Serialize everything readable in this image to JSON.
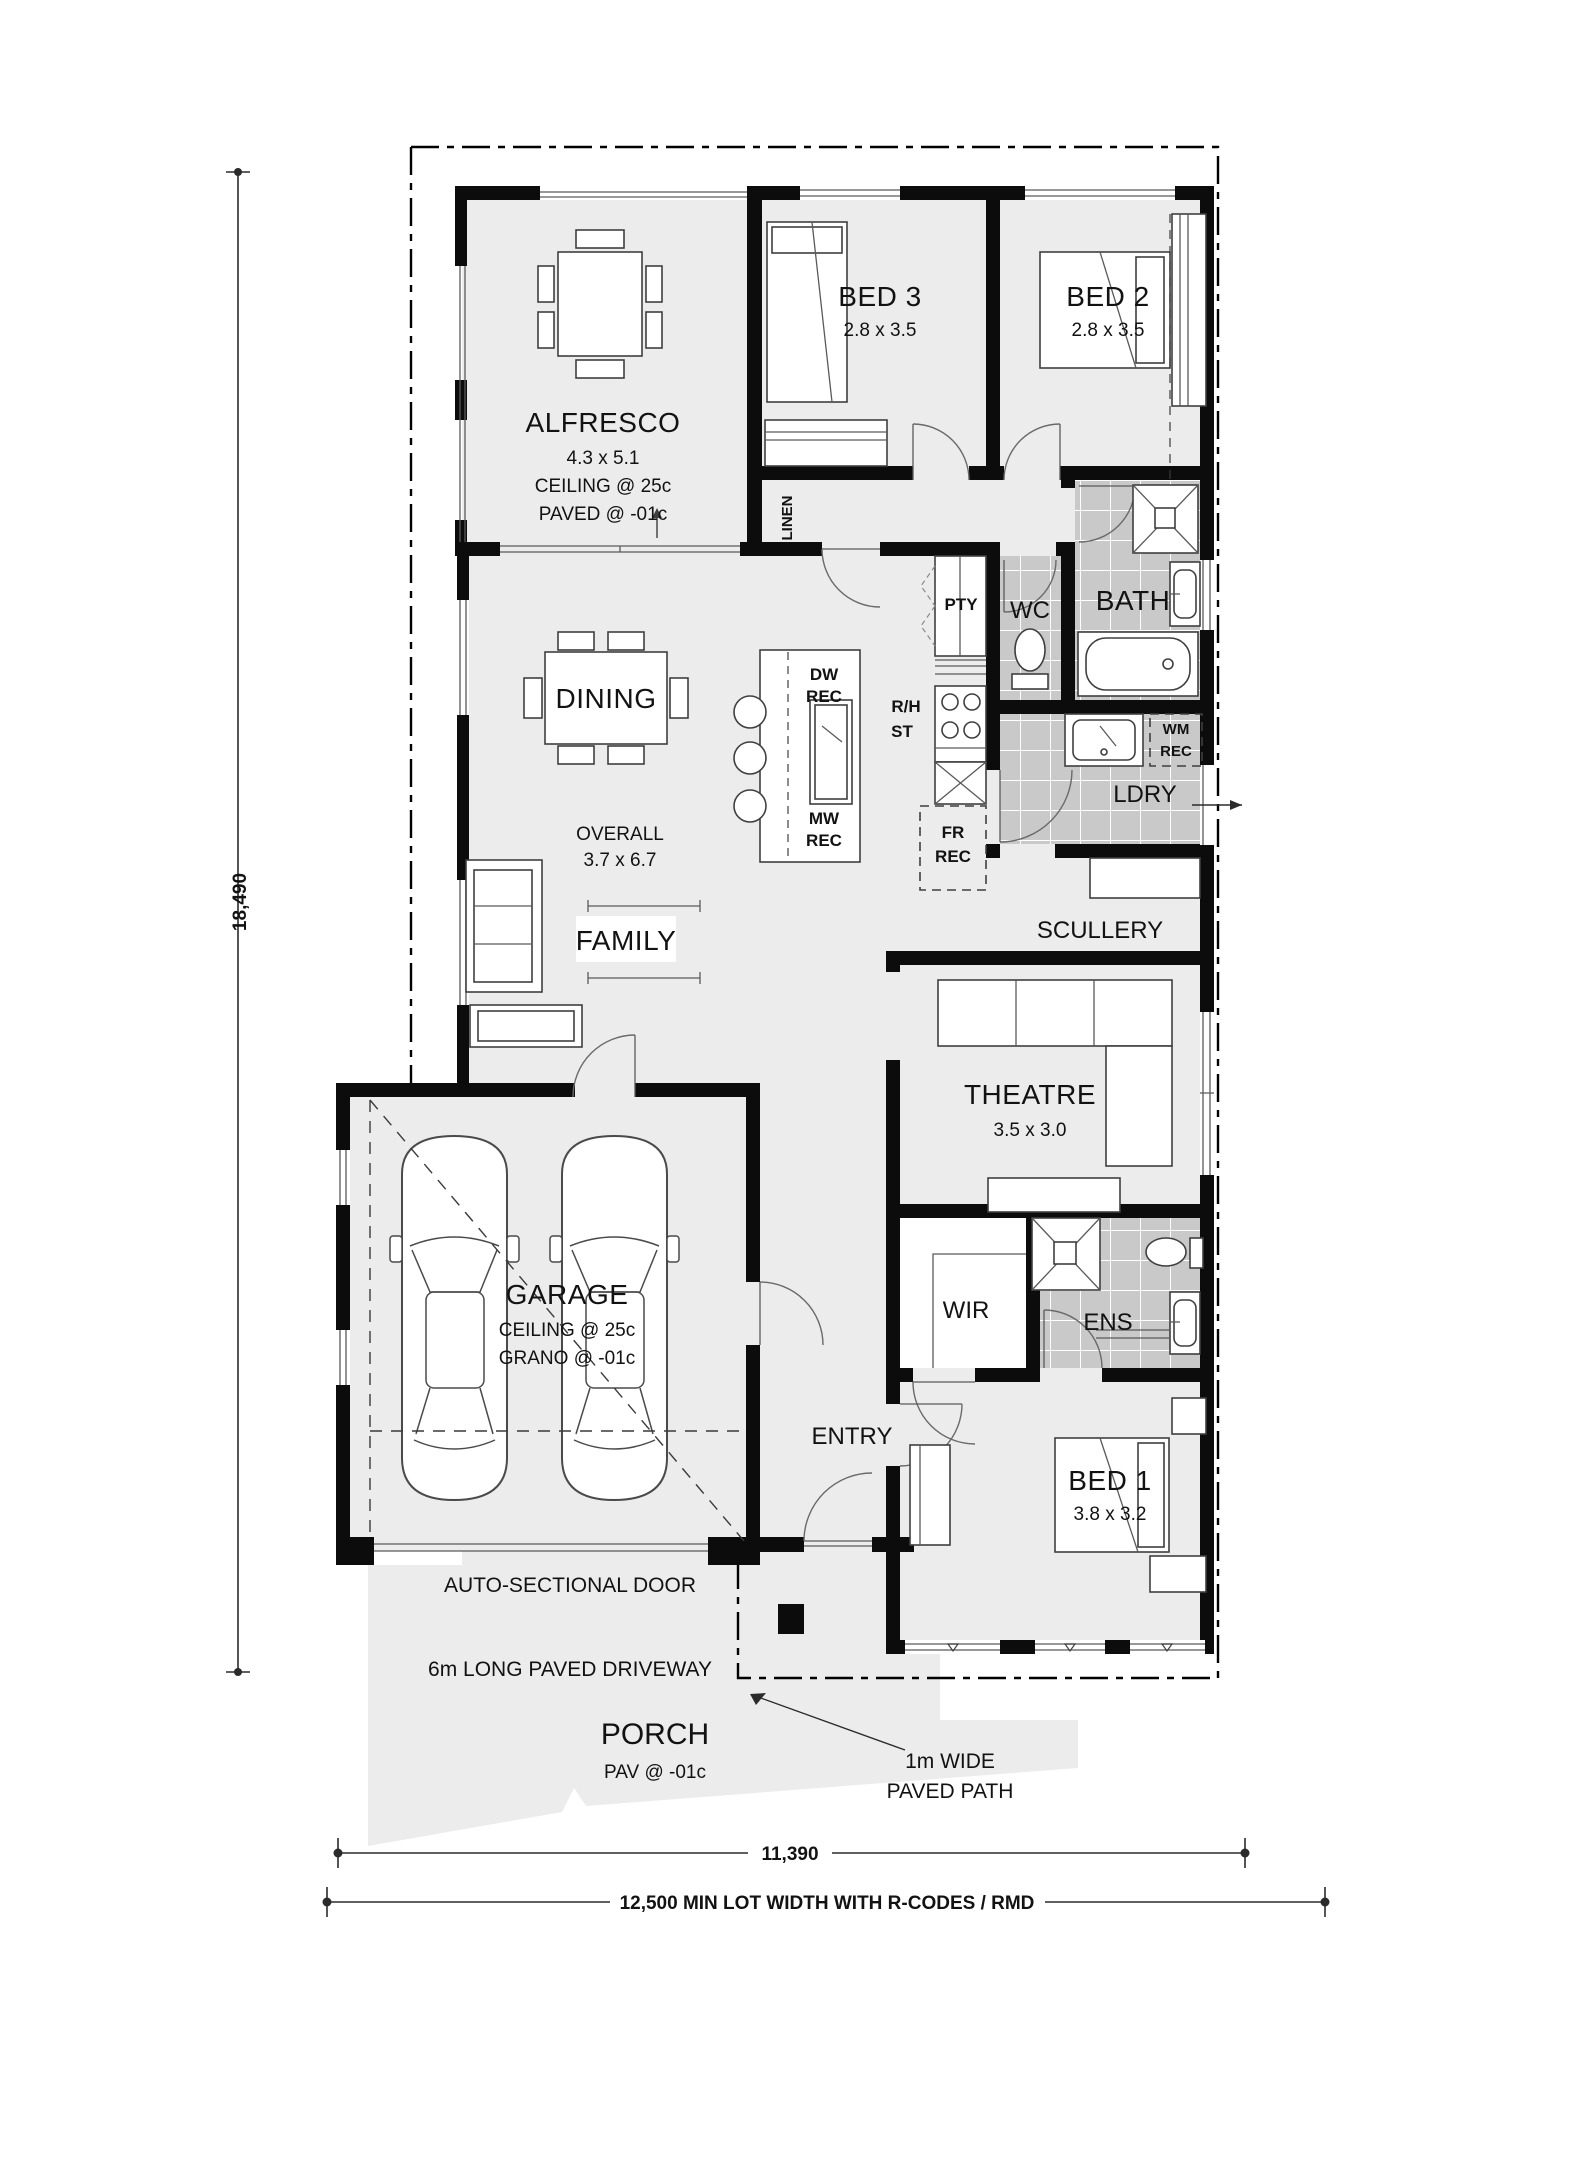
{
  "colors": {
    "wall": "#0c0c0c",
    "floor": "#ececec",
    "tile": "#c9c9c9",
    "paper": "#ffffff"
  },
  "rooms": {
    "alfresco": {
      "name": "ALFRESCO",
      "dim": "4.3 x 5.1",
      "notes": [
        "CEILING @ 25c",
        "PAVED @ -01c"
      ]
    },
    "bed3": {
      "name": "BED 3",
      "dim": "2.8 x 3.5"
    },
    "bed2": {
      "name": "BED 2",
      "dim": "2.8 x 3.5"
    },
    "linen": {
      "name": "LINEN"
    },
    "wc": {
      "name": "WC"
    },
    "bath": {
      "name": "BATH"
    },
    "dining": {
      "name": "DINING"
    },
    "overall": {
      "label": "OVERALL",
      "dim": "3.7 x 6.7"
    },
    "family": {
      "name": "FAMILY"
    },
    "ldry": {
      "name": "LDRY"
    },
    "scullery": {
      "name": "SCULLERY"
    },
    "theatre": {
      "name": "THEATRE",
      "dim": "3.5 x 3.0"
    },
    "garage": {
      "name": "GARAGE",
      "notes": [
        "CEILING @ 25c",
        "GRANO @ -01c"
      ]
    },
    "wir": {
      "name": "WIR"
    },
    "ens": {
      "name": "ENS"
    },
    "entry": {
      "name": "ENTRY"
    },
    "bed1": {
      "name": "BED 1",
      "dim": "3.8 x 3.2"
    },
    "porch": {
      "name": "PORCH",
      "note": "PAV @ -01c"
    }
  },
  "kitchen": {
    "pty": "PTY",
    "dw_rec": [
      "DW",
      "REC"
    ],
    "mw_rec": [
      "MW",
      "REC"
    ],
    "fr_rec": [
      "FR",
      "REC"
    ],
    "rh_st": [
      "R/H",
      "ST"
    ],
    "wm_rec": [
      "WM",
      "REC"
    ]
  },
  "annotations": {
    "auto_door": "AUTO-SECTIONAL DOOR",
    "driveway": "6m LONG PAVED DRIVEWAY",
    "paved_path": [
      "1m WIDE",
      "PAVED PATH"
    ]
  },
  "dimensions": {
    "lot_depth": "18,490",
    "house_width": "11,390",
    "lot_width": "12,500 MIN LOT WIDTH WITH R-CODES / RMD"
  }
}
